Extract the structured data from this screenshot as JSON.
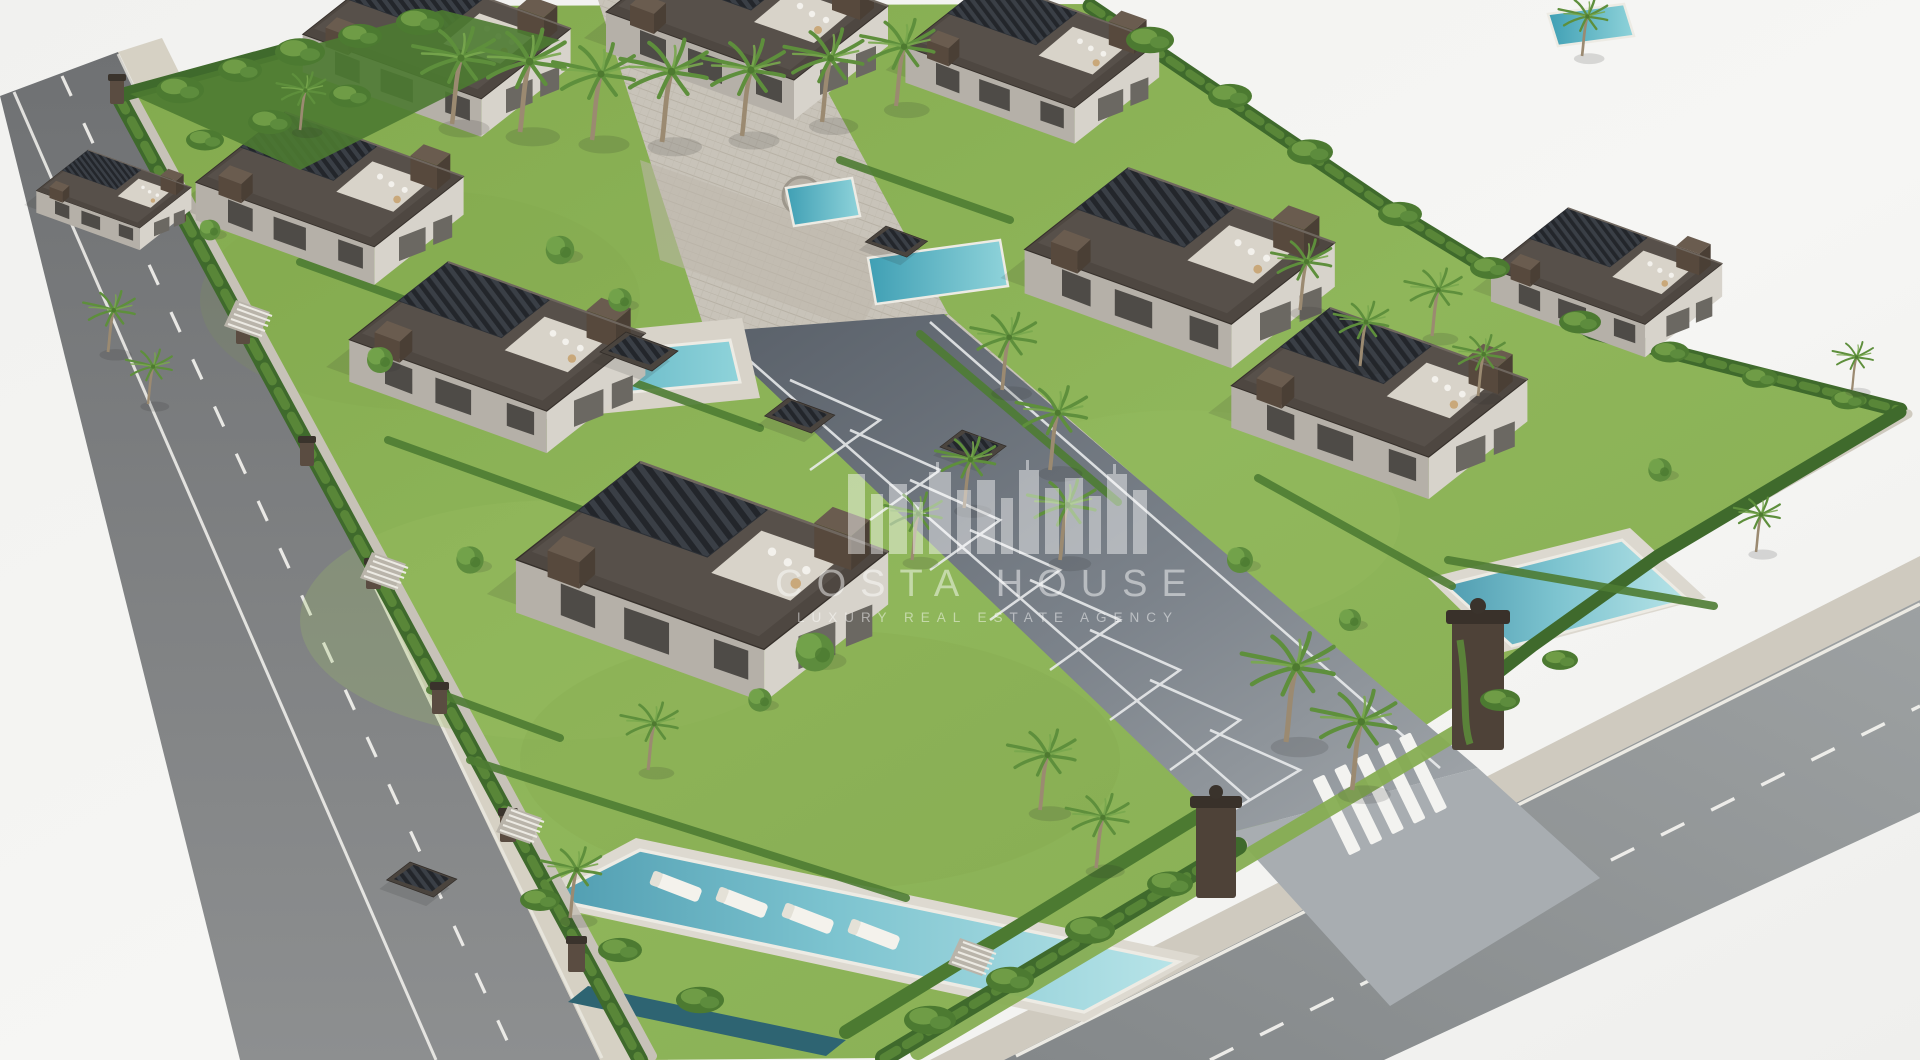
{
  "watermark": {
    "brand": "COSTA HOUSE",
    "tagline": "LUXURY REAL ESTATE AGENCY",
    "logo_icon": "city-skyline-icon",
    "color": "#ffffff",
    "opacity": "0.48"
  },
  "colors": {
    "background": "#f4f4f2",
    "asphalt": "#7f8182",
    "asphalt_light": "#939798",
    "road_line": "#f5f4f0",
    "sidewalk": "#d6d1c4",
    "curb": "#eceae3",
    "lawn": "#8db058",
    "lawn_light": "#9dc065",
    "hedge": "#3f6a2c",
    "hedge_light": "#5c8a3a",
    "foliage": "#4c7a31",
    "foliage_light": "#7fae54",
    "palm_frond": "#5e8f3c",
    "palm_trunk": "#9b8a71",
    "roof_dark": "#4e4741",
    "roof_slab": "#57504a",
    "pergola_slat": "#2c3036",
    "wall_light": "#d7d3cb",
    "wall_shade": "#b5b0a8",
    "brick": "#57493d",
    "paving": "#c8c3b9",
    "driveway_dark": "#5c636e",
    "driveway_light": "#9aa0a5",
    "pool_deep": "#3f9fb4",
    "pool_shallow": "#aadfe6",
    "pool_rim": "#edebe4",
    "shadow": "#2b2b28"
  }
}
